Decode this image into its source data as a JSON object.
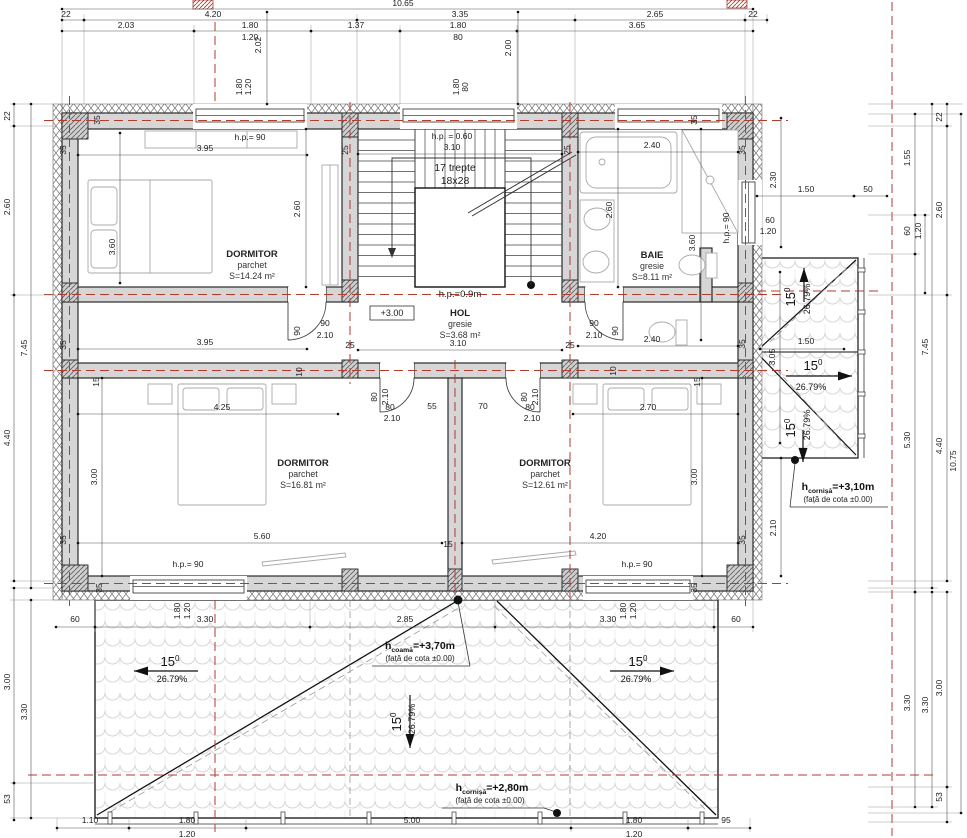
{
  "plan": {
    "rooms": [
      {
        "name": "DORMITOR",
        "floor": "parchet",
        "area": "S=14.24 m²",
        "x": 252,
        "y": 257
      },
      {
        "name": "DORMITOR",
        "floor": "parchet",
        "area": "S=16.81 m²",
        "x": 303,
        "y": 466
      },
      {
        "name": "DORMITOR",
        "floor": "parchet",
        "area": "S=12.61 m²",
        "x": 545,
        "y": 466
      },
      {
        "name": "BAIE",
        "floor": "gresie",
        "area": "S=8.11 m²",
        "x": 652,
        "y": 258
      },
      {
        "name": "HOL",
        "floor": "gresie",
        "area": "S=3.68 m²",
        "x": 460,
        "y": 316
      }
    ],
    "level_marker": "+3.00",
    "roof": {
      "slope_deg": "15",
      "slope_sup": "0",
      "slope_pct": "26.79%",
      "heights": [
        {
          "h": "h",
          "sub": "coamă",
          "val": "=+3,70m",
          "note": "(față de cota ±0.00)"
        },
        {
          "h": "h",
          "sub": "cornișă",
          "val": "=+3,10m",
          "note": "(față de cota ±0.00)"
        },
        {
          "h": "h",
          "sub": "cornișă",
          "val": "=+2,80m",
          "note": "(față de cota ±0.00)"
        }
      ]
    },
    "slope_marks": [
      {
        "line": [
          134,
          671,
          198,
          671
        ],
        "head": [
          134,
          671
        ],
        "dir": "left",
        "deg": [
          170,
          666
        ],
        "pct": [
          172,
          682
        ],
        "rot": 0
      },
      {
        "line": [
          410,
          695,
          410,
          748
        ],
        "head": [
          410,
          748
        ],
        "dir": "down",
        "deg": [
          401,
          722
        ],
        "pct": [
          415,
          719
        ],
        "rot": 1
      },
      {
        "line": [
          610,
          671,
          674,
          671
        ],
        "head": [
          674,
          671
        ],
        "dir": "right",
        "deg": [
          638,
          666
        ],
        "pct": [
          636,
          682
        ],
        "rot": 0
      },
      {
        "line": [
          804,
          302,
          804,
          268
        ],
        "head": [
          804,
          268
        ],
        "dir": "up",
        "deg": [
          795,
          297
        ],
        "pct": [
          810,
          299
        ],
        "rot": 1
      },
      {
        "line": [
          786,
          376,
          852,
          376
        ],
        "head": [
          852,
          376
        ],
        "dir": "right",
        "deg": [
          813,
          370
        ],
        "pct": [
          811,
          390
        ],
        "rot": 0
      },
      {
        "line": [
          803,
          430,
          803,
          462
        ],
        "head": [
          803,
          462
        ],
        "dir": "down",
        "deg": [
          795,
          428
        ],
        "pct": [
          810,
          425
        ],
        "rot": 1
      }
    ],
    "dim_labels": [
      {
        "t": "10.65",
        "x": 403,
        "y": 6,
        "seg": [
          62,
          9,
          753,
          9
        ]
      },
      {
        "t": "22",
        "x": 66,
        "y": 17,
        "seg": [
          62,
          20,
          84,
          20
        ]
      },
      {
        "t": "4.20",
        "x": 213,
        "y": 17,
        "seg": [
          84,
          20,
          357,
          20
        ]
      },
      {
        "t": "3.35",
        "x": 460,
        "y": 17,
        "seg": [
          357,
          20,
          575,
          20
        ]
      },
      {
        "t": "2.65",
        "x": 655,
        "y": 17,
        "seg": [
          575,
          20,
          745,
          20
        ]
      },
      {
        "t": "22",
        "x": 753,
        "y": 17,
        "seg": [
          745,
          20,
          767,
          20
        ]
      },
      {
        "t": "2.03",
        "x": 126,
        "y": 28,
        "seg": [
          62,
          31,
          194,
          31
        ]
      },
      {
        "t": "1.80",
        "x": 250,
        "y": 28,
        "seg": [
          194,
          31,
          311,
          31
        ]
      },
      {
        "t": "1.20",
        "x": 250,
        "y": 40
      },
      {
        "t": "1.37",
        "x": 356,
        "y": 28,
        "seg": [
          311,
          31,
          400,
          31
        ]
      },
      {
        "t": "1.80",
        "x": 458,
        "y": 28,
        "seg": [
          400,
          31,
          517,
          31
        ]
      },
      {
        "t": "80",
        "x": 458,
        "y": 40
      },
      {
        "t": "3.65",
        "x": 637,
        "y": 28,
        "seg": [
          517,
          31,
          753,
          31
        ]
      },
      {
        "t": "2.02",
        "x": 261,
        "y": 45,
        "r": 1,
        "seg": [
          267,
          12,
          267,
          104
        ]
      },
      {
        "t": "2.00",
        "x": 511,
        "y": 48,
        "r": 1,
        "seg": [
          518,
          12,
          518,
          104
        ]
      },
      {
        "t": "1.80",
        "x": 242,
        "y": 87,
        "r": 1
      },
      {
        "t": "1.20",
        "x": 251,
        "y": 87,
        "r": 1
      },
      {
        "t": "1.80",
        "x": 459,
        "y": 87,
        "r": 1
      },
      {
        "t": "80",
        "x": 468,
        "y": 87,
        "r": 1
      },
      {
        "t": "22",
        "x": 10,
        "y": 116,
        "r": 1,
        "seg": [
          14,
          104,
          14,
          126
        ]
      },
      {
        "t": "2.60",
        "x": 10,
        "y": 207,
        "r": 1,
        "seg": [
          14,
          126,
          14,
          295
        ]
      },
      {
        "t": "4.40",
        "x": 10,
        "y": 438,
        "r": 1,
        "seg": [
          14,
          295,
          14,
          581
        ]
      },
      {
        "t": "7.45",
        "x": 27,
        "y": 348,
        "r": 1,
        "seg": [
          31,
          104,
          31,
          588
        ]
      },
      {
        "t": "3.00",
        "x": 10,
        "y": 682,
        "r": 1,
        "seg": [
          14,
          588,
          14,
          783
        ]
      },
      {
        "t": "53",
        "x": 10,
        "y": 799,
        "r": 1,
        "seg": [
          14,
          783,
          14,
          820
        ]
      },
      {
        "t": "3.30",
        "x": 27,
        "y": 712,
        "r": 1,
        "seg": [
          31,
          600,
          31,
          818
        ]
      },
      {
        "t": "35",
        "x": 66,
        "y": 150,
        "r": 1
      },
      {
        "t": "35",
        "x": 66,
        "y": 345,
        "r": 1
      },
      {
        "t": "35",
        "x": 66,
        "y": 540,
        "r": 1
      },
      {
        "t": "35",
        "x": 100,
        "y": 120,
        "r": 1
      },
      {
        "t": "35",
        "x": 697,
        "y": 120,
        "r": 1
      },
      {
        "t": "35",
        "x": 745,
        "y": 150,
        "r": 1
      },
      {
        "t": "35",
        "x": 745,
        "y": 344,
        "r": 1
      },
      {
        "t": "35",
        "x": 745,
        "y": 540,
        "r": 1
      },
      {
        "t": "35",
        "x": 102,
        "y": 588,
        "r": 1
      },
      {
        "t": "35",
        "x": 697,
        "y": 588,
        "r": 1
      },
      {
        "t": "25",
        "x": 348,
        "y": 150,
        "r": 1
      },
      {
        "t": "25",
        "x": 570,
        "y": 150,
        "r": 1
      },
      {
        "t": "25",
        "x": 350,
        "y": 348
      },
      {
        "t": "25",
        "x": 570,
        "y": 348
      },
      {
        "t": "15",
        "x": 99,
        "y": 382,
        "r": 1
      },
      {
        "t": "15",
        "x": 700,
        "y": 382,
        "r": 1
      },
      {
        "t": "15",
        "x": 448,
        "y": 547
      },
      {
        "t": "10",
        "x": 302,
        "y": 372,
        "r": 1
      },
      {
        "t": "10",
        "x": 616,
        "y": 371,
        "r": 1
      },
      {
        "t": "h.p.= 90",
        "x": 250,
        "y": 140
      },
      {
        "t": "3.95",
        "x": 205,
        "y": 151,
        "seg": [
          78,
          155,
          307,
          155
        ]
      },
      {
        "t": "2.60",
        "x": 300,
        "y": 209,
        "r": 1,
        "seg": [
          306,
          129,
          306,
          287
        ]
      },
      {
        "t": "3.60",
        "x": 115,
        "y": 247,
        "r": 1,
        "seg": [
          120,
          133,
          120,
          283
        ]
      },
      {
        "t": "3.95",
        "x": 205,
        "y": 345,
        "seg": [
          78,
          349,
          307,
          349
        ]
      },
      {
        "t": "h.p. = 0.60",
        "x": 452,
        "y": 139
      },
      {
        "t": "3.10",
        "x": 452,
        "y": 150,
        "seg": [
          358,
          154,
          562,
          154
        ]
      },
      {
        "t": "17 trepte",
        "x": 455,
        "y": 171,
        "fs": 10.5
      },
      {
        "t": "18x28",
        "x": 455,
        "y": 184,
        "fs": 10.5
      },
      {
        "t": "h.p.=0.9m",
        "x": 460,
        "y": 297,
        "fs": 9.5
      },
      {
        "t": "3.10",
        "x": 458,
        "y": 346,
        "seg": [
          358,
          350,
          562,
          350
        ]
      },
      {
        "t": "2.40",
        "x": 652,
        "y": 148,
        "seg": [
          578,
          152,
          738,
          152
        ]
      },
      {
        "t": "2.60",
        "x": 612,
        "y": 210,
        "r": 1,
        "seg": [
          618,
          129,
          618,
          287
        ]
      },
      {
        "t": "3.60",
        "x": 695,
        "y": 243,
        "r": 1,
        "seg": [
          701,
          129,
          701,
          340
        ]
      },
      {
        "t": "h.p.= 90",
        "x": 729,
        "y": 228,
        "r": 1
      },
      {
        "t": "2.40",
        "x": 652,
        "y": 342,
        "seg": [
          578,
          346,
          738,
          346
        ]
      },
      {
        "t": "60",
        "x": 770,
        "y": 223
      },
      {
        "t": "1.20",
        "x": 768,
        "y": 234
      },
      {
        "t": "2.30",
        "x": 776,
        "y": 180,
        "r": 1,
        "seg": [
          781,
          118,
          781,
          247
        ]
      },
      {
        "t": "1.50",
        "x": 806,
        "y": 192,
        "seg": [
          757,
          196,
          854,
          196
        ]
      },
      {
        "t": "50",
        "x": 868,
        "y": 192,
        "seg": [
          854,
          196,
          887,
          196
        ]
      },
      {
        "t": "3.05",
        "x": 775,
        "y": 357,
        "r": 1,
        "seg": [
          780,
          272,
          780,
          443
        ]
      },
      {
        "t": "1.50",
        "x": 806,
        "y": 344,
        "seg": [
          760,
          349,
          844,
          349
        ]
      },
      {
        "t": "2.10",
        "x": 776,
        "y": 528,
        "r": 1,
        "seg": [
          781,
          458,
          781,
          576
        ]
      },
      {
        "t": "1.55",
        "x": 910,
        "y": 158,
        "r": 1,
        "seg": [
          915,
          114,
          915,
          215
        ]
      },
      {
        "t": "60",
        "x": 910,
        "y": 231,
        "r": 1,
        "seg": [
          915,
          215,
          915,
          254
        ]
      },
      {
        "t": "1.20",
        "x": 921,
        "y": 231,
        "r": 1,
        "seg": [
          925,
          215,
          925,
          293
        ]
      },
      {
        "t": "5.30",
        "x": 910,
        "y": 440,
        "r": 1,
        "seg": [
          915,
          254,
          915,
          592
        ]
      },
      {
        "t": "3.30",
        "x": 910,
        "y": 703,
        "r": 1,
        "seg": [
          915,
          592,
          915,
          807
        ]
      },
      {
        "t": "7.45",
        "x": 928,
        "y": 347,
        "r": 1,
        "seg": [
          932,
          104,
          932,
          588
        ]
      },
      {
        "t": "3.30",
        "x": 928,
        "y": 705,
        "r": 1,
        "seg": [
          932,
          592,
          932,
          807
        ]
      },
      {
        "t": "22",
        "x": 942,
        "y": 117,
        "r": 1,
        "seg": [
          947,
          104,
          947,
          126
        ]
      },
      {
        "t": "2.60",
        "x": 942,
        "y": 210,
        "r": 1,
        "seg": [
          947,
          126,
          947,
          295
        ]
      },
      {
        "t": "4.40",
        "x": 942,
        "y": 446,
        "r": 1,
        "seg": [
          947,
          295,
          947,
          581
        ]
      },
      {
        "t": "3.00",
        "x": 942,
        "y": 688,
        "r": 1,
        "seg": [
          947,
          592,
          947,
          787
        ]
      },
      {
        "t": "53",
        "x": 942,
        "y": 797,
        "r": 1,
        "seg": [
          947,
          787,
          947,
          822
        ]
      },
      {
        "t": "10.75",
        "x": 956,
        "y": 461,
        "r": 1,
        "seg": [
          961,
          114,
          961,
          813
        ]
      },
      {
        "t": "4.25",
        "x": 222,
        "y": 410,
        "seg": [
          78,
          414,
          338,
          414
        ]
      },
      {
        "t": "3.00",
        "x": 97,
        "y": 477,
        "r": 1,
        "seg": [
          102,
          378,
          102,
          576
        ]
      },
      {
        "t": "5.60",
        "x": 262,
        "y": 539,
        "seg": [
          78,
          543,
          442,
          543
        ]
      },
      {
        "t": "h.p.= 90",
        "x": 188,
        "y": 567
      },
      {
        "t": "2.70",
        "x": 648,
        "y": 410,
        "seg": [
          573,
          414,
          738,
          414
        ]
      },
      {
        "t": "3.00",
        "x": 697,
        "y": 477,
        "r": 1,
        "seg": [
          702,
          378,
          702,
          576
        ]
      },
      {
        "t": "4.20",
        "x": 598,
        "y": 539,
        "seg": [
          462,
          543,
          738,
          543
        ]
      },
      {
        "t": "h.p.= 90",
        "x": 637,
        "y": 567
      },
      {
        "t": "90",
        "x": 325,
        "y": 326
      },
      {
        "t": "2.10",
        "x": 325,
        "y": 338
      },
      {
        "t": "90",
        "x": 594,
        "y": 326
      },
      {
        "t": "2.10",
        "x": 594,
        "y": 338
      },
      {
        "t": "90",
        "x": 300,
        "y": 331,
        "r": 1
      },
      {
        "t": "90",
        "x": 618,
        "y": 331,
        "r": 1
      },
      {
        "t": "80",
        "x": 377,
        "y": 397,
        "r": 1
      },
      {
        "t": "2.10",
        "x": 388,
        "y": 397,
        "r": 1
      },
      {
        "t": "80",
        "x": 527,
        "y": 397,
        "r": 1
      },
      {
        "t": "2.10",
        "x": 538,
        "y": 397,
        "r": 1
      },
      {
        "t": "80",
        "x": 390,
        "y": 410
      },
      {
        "t": "2.10",
        "x": 392,
        "y": 421
      },
      {
        "t": "80",
        "x": 530,
        "y": 410
      },
      {
        "t": "2.10",
        "x": 532,
        "y": 421
      },
      {
        "t": "55",
        "x": 432,
        "y": 409
      },
      {
        "t": "70",
        "x": 483,
        "y": 409
      },
      {
        "t": "60",
        "x": 75,
        "y": 622,
        "seg": [
          56,
          627,
          95,
          627
        ]
      },
      {
        "t": "3.30",
        "x": 205,
        "y": 622,
        "seg": [
          95,
          627,
          310,
          627
        ]
      },
      {
        "t": "2.85",
        "x": 405,
        "y": 622,
        "seg": [
          310,
          627,
          495,
          627
        ]
      },
      {
        "t": "3.30",
        "x": 608,
        "y": 622,
        "seg": [
          495,
          627,
          714,
          627
        ]
      },
      {
        "t": "60",
        "x": 736,
        "y": 622,
        "seg": [
          714,
          627,
          753,
          627
        ]
      },
      {
        "t": "1.80",
        "x": 180,
        "y": 611,
        "r": 1
      },
      {
        "t": "1.20",
        "x": 190,
        "y": 611,
        "r": 1
      },
      {
        "t": "1.80",
        "x": 626,
        "y": 611,
        "r": 1
      },
      {
        "t": "1.20",
        "x": 636,
        "y": 611,
        "r": 1
      },
      {
        "t": "1.10",
        "x": 90,
        "y": 823,
        "seg": [
          57,
          828,
          129,
          828
        ]
      },
      {
        "t": "1.80",
        "x": 187,
        "y": 823,
        "seg": [
          129,
          828,
          246,
          828
        ]
      },
      {
        "t": "5.00",
        "x": 412,
        "y": 823,
        "seg": [
          246,
          828,
          571,
          828
        ]
      },
      {
        "t": "1.80",
        "x": 634,
        "y": 823,
        "seg": [
          571,
          828,
          688,
          828
        ]
      },
      {
        "t": "95",
        "x": 726,
        "y": 823,
        "seg": [
          688,
          828,
          750,
          828
        ]
      },
      {
        "t": "1.20",
        "x": 187,
        "y": 837
      },
      {
        "t": "1.20",
        "x": 634,
        "y": 837
      },
      {
        "t": "+3.00",
        "x": 392,
        "y": 316,
        "fs": 9
      }
    ]
  }
}
